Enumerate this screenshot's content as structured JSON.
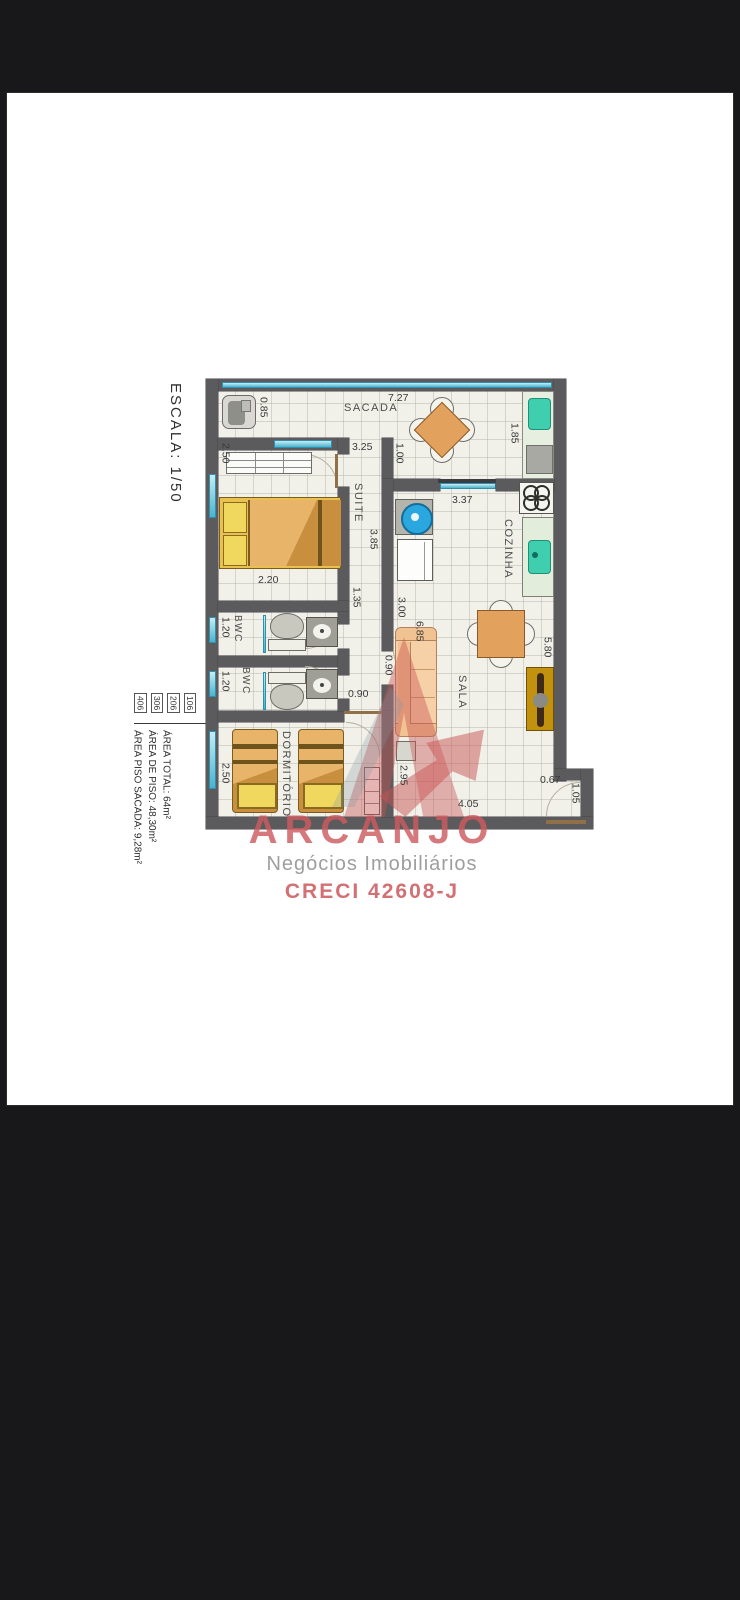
{
  "colors": {
    "page_bg": "#18181a",
    "sheet_bg": "#ffffff",
    "wall": "#5b5a5c",
    "floor": "#f1f0e9",
    "window_glass": "#4ab3cf",
    "furniture_wood": "#e2a15c",
    "bed_blanket": "#c78f3e",
    "pillow": "#efd24f",
    "sink_teal": "#3fcfae",
    "tank_blue": "#2aa7df",
    "tv_rack_gold": "#c2920f",
    "watermark_red": "#cc5c60",
    "label_gray": "#3a3a3a"
  },
  "scale_label": "ESCALA: 1/50",
  "unit_tags": [
    "406",
    "306",
    "206",
    "106"
  ],
  "area_lines": [
    "ÁREA TOTAL: 64m²",
    "ÁREA DE PISO: 48,30m²",
    "ÁREA PISO SACADA: 9,28m²"
  ],
  "rooms": {
    "sacada": "SACADA",
    "suite": "SUITE",
    "bwc1": "BWC",
    "bwc2": "BWC",
    "dormitorio": "DORMITÓRIO",
    "cozinha": "COZINHA",
    "sala": "SALA"
  },
  "dims": {
    "sacada_width": "7.27",
    "tub": "0.85",
    "balcony_counter": "1.85",
    "suite_left": "2.50",
    "suite_top": "3.25",
    "sacada_door": "1.00",
    "kitchen_width": "3.37",
    "suite_depth": "3.85",
    "hall": "1.35",
    "kitchen_len": "3.00",
    "sala_len": "6.85",
    "bwc_top": "2.20",
    "bwc1_left": "1.20",
    "bwc2_left": "1.20",
    "hall_door": "0.90",
    "dorm_door": "0.90",
    "dorm_left": "2.50",
    "sala_right": "5.80",
    "sofa_wall": "2.95",
    "sala_bottom": "4.05",
    "entry_notch": "0.67",
    "entry_door": "1.05"
  },
  "logo": {
    "name": "ARCANJO",
    "subtitle": "Negócios Imobiliários",
    "creci": "CRECI 42608-J"
  }
}
